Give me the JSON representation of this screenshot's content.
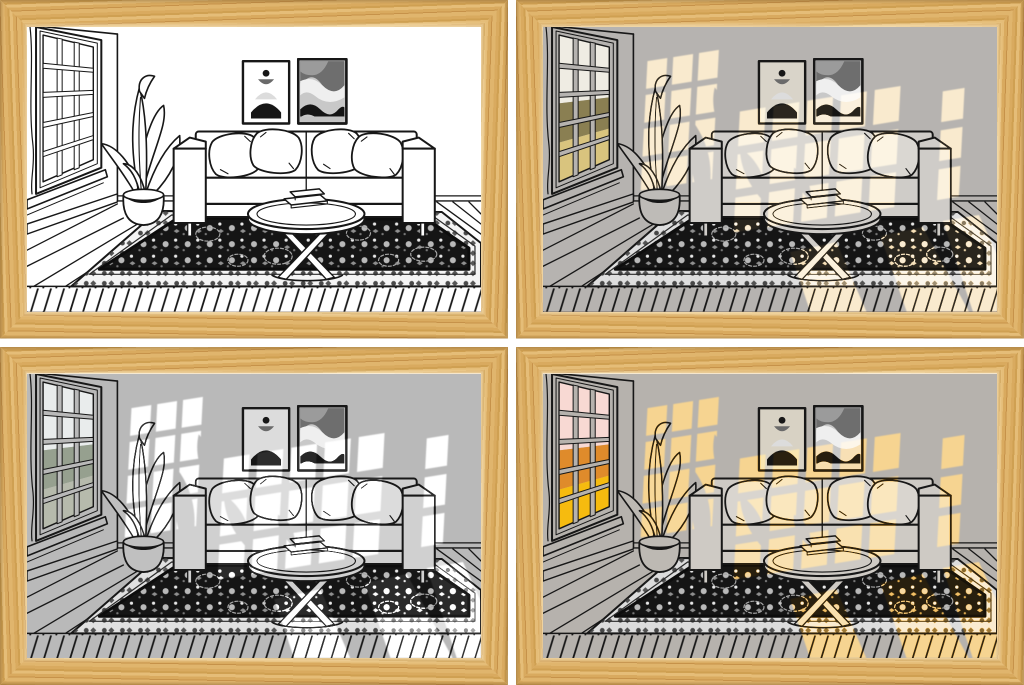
{
  "collage": {
    "rows": 2,
    "cols": 2,
    "gutter_px": 8,
    "gutter_color": "#ffffff",
    "frame": {
      "material": "light-oak-wood",
      "vars": {
        "--wood1": "#d9aa5f",
        "--wood2": "#cfa052",
        "--wood3": "#e5bd78",
        "--wood4": "#c6924a",
        "--wood5": "#e0b56d"
      }
    }
  },
  "scene": {
    "subject": "living-room-line-art",
    "elements": [
      "paned-window",
      "curtain-edge",
      "potted-plant",
      "wall-art-abstract-arch",
      "wall-art-abstract-waves",
      "sofa",
      "throw-pillows",
      "round-coffee-table",
      "books",
      "oriental-rug",
      "plank-wood-floor"
    ],
    "pillow_count": 4,
    "wall_art_count": 2,
    "book_count": 2,
    "line_color": "#171717",
    "rug_field_color": "#151515"
  },
  "panels": [
    {
      "id": "top-left",
      "variant": "line-art-no-light",
      "vars": {
        "--wall": "#ffffff",
        "--sofa": "#ffffff",
        "--pillow": "#ffffff",
        "--leaf": "#ffffff",
        "--artbg": "#ffffff",
        "--rugborder": "#f4f4f4",
        "--sky": "#ffffff",
        "--trees": "#ffffff",
        "--grass": "#ffffff",
        "--lightcolor": "#ffffff",
        "--lightopacity": "0"
      }
    },
    {
      "id": "top-right",
      "variant": "warm-daylight",
      "vars": {
        "--wall": "#b6b3b0",
        "--sofa": "#cfccc8",
        "--pillow": "#dad7d2",
        "--leaf": "#bebbb7",
        "--artbg": "#d9d4c9",
        "--rugborder": "#dedede",
        "--sky": "#efece3",
        "--trees": "#8a7f52",
        "--grass": "#d9c47e",
        "--lightcolor": "#f6ddb0",
        "--lightopacity": "1"
      }
    },
    {
      "id": "bottom-left",
      "variant": "cool-white-light",
      "vars": {
        "--wall": "#b9b9b9",
        "--sofa": "#d0d0d0",
        "--pillow": "#dcdcdc",
        "--leaf": "#c0c0c0",
        "--artbg": "#dcdcdc",
        "--rugborder": "#e0e0e0",
        "--sky": "#e9ecec",
        "--trees": "#96a08f",
        "--grass": "#b6baac",
        "--lightcolor": "#ffffff",
        "--lightopacity": "1"
      }
    },
    {
      "id": "bottom-right",
      "variant": "golden-hour-light",
      "vars": {
        "--wall": "#b6b2ad",
        "--sofa": "#cecac4",
        "--pillow": "#d9d5cf",
        "--leaf": "#bdb9b3",
        "--artbg": "#d8d2c4",
        "--rugborder": "#dcdcdc",
        "--sky": "#f8d9d3",
        "--trees": "#df8b2b",
        "--grass": "#f6bb0f",
        "--lightcolor": "#f0b854",
        "--lightopacity": "1"
      }
    }
  ]
}
